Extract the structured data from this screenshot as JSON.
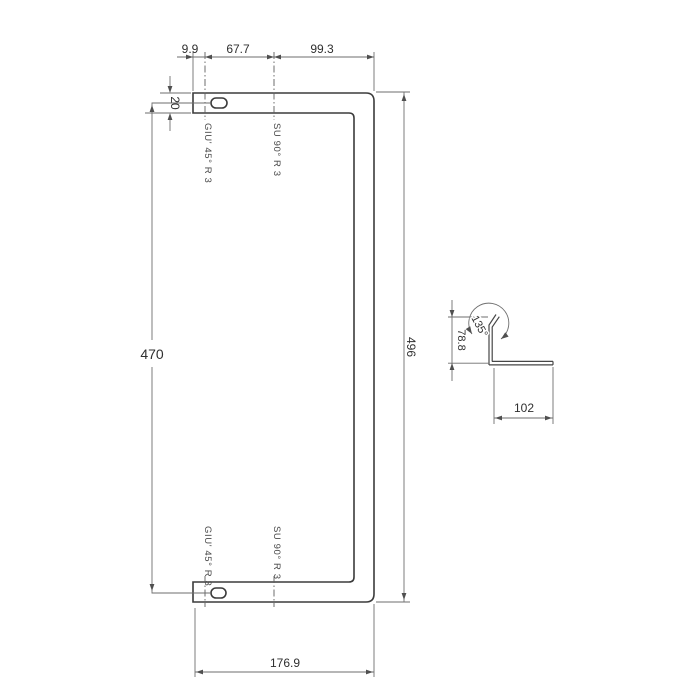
{
  "dims": {
    "top_segment_1": "9.9",
    "top_segment_2": "67.7",
    "top_segment_3": "99.3",
    "leg_thickness": "20",
    "inner_height": "470",
    "outer_height": "496",
    "bottom_width": "176.9",
    "section_height": "78.8",
    "section_width": "102",
    "section_angle": "135°"
  },
  "bend_labels": {
    "bend_down_45": "GIU' 45° R 3",
    "bend_up_90": "SU 90° R 3"
  },
  "colors": {
    "line": "#3b3b3b",
    "dim_line": "#6e6e6e",
    "text": "#2f2f2f",
    "background": "#ffffff"
  }
}
